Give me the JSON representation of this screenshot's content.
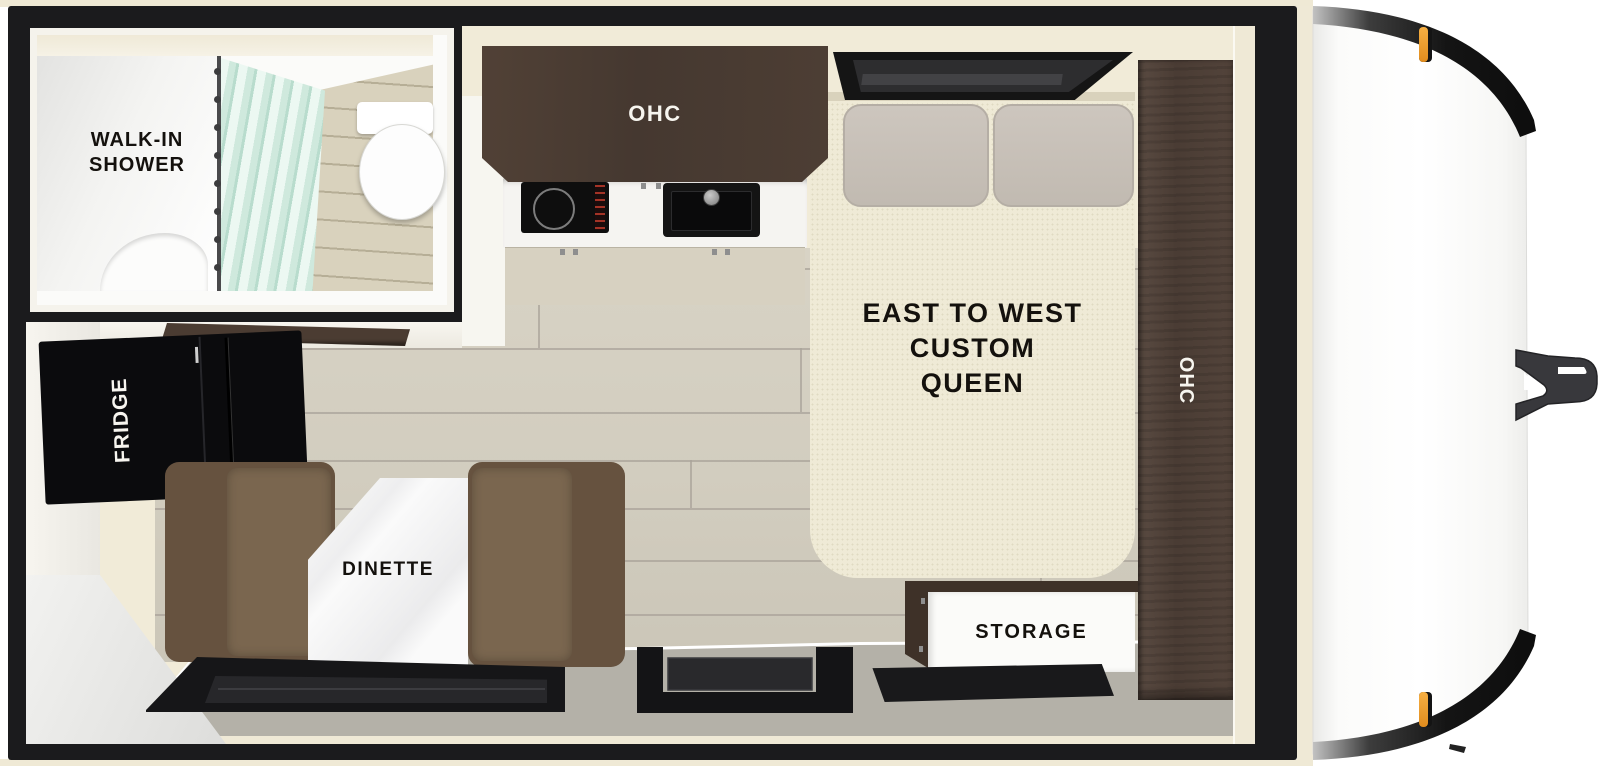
{
  "floorplan": {
    "bathroom": {
      "label_line1": "WALK-IN",
      "label_line2": "SHOWER"
    },
    "kitchen": {
      "overhead_cabinet_label": "OHC"
    },
    "bedroom": {
      "bed_label_line1": "EAST TO WEST",
      "bed_label_line2": "CUSTOM",
      "bed_label_line3": "QUEEN",
      "wardrobe_label": "OHC"
    },
    "appliances": {
      "fridge_label": "FRIDGE"
    },
    "dining": {
      "dinette_label": "DINETTE"
    },
    "storage": {
      "storage_label": "STORAGE"
    }
  },
  "colors": {
    "frame_black": "#1b1b1d",
    "interior_cream": "#f1ebd8",
    "floor_plank": "#d3cec0",
    "entry_floor_gray": "#b4b1a8",
    "cabinet_wood_dark": "#4c3c33",
    "upholstery_brown": "#6f5b48",
    "curtain_mint": "#d6ede3",
    "mattress_cream": "#efead6",
    "marker_light_orange": "#f2a235",
    "trailer_body_white": "#ffffff"
  }
}
